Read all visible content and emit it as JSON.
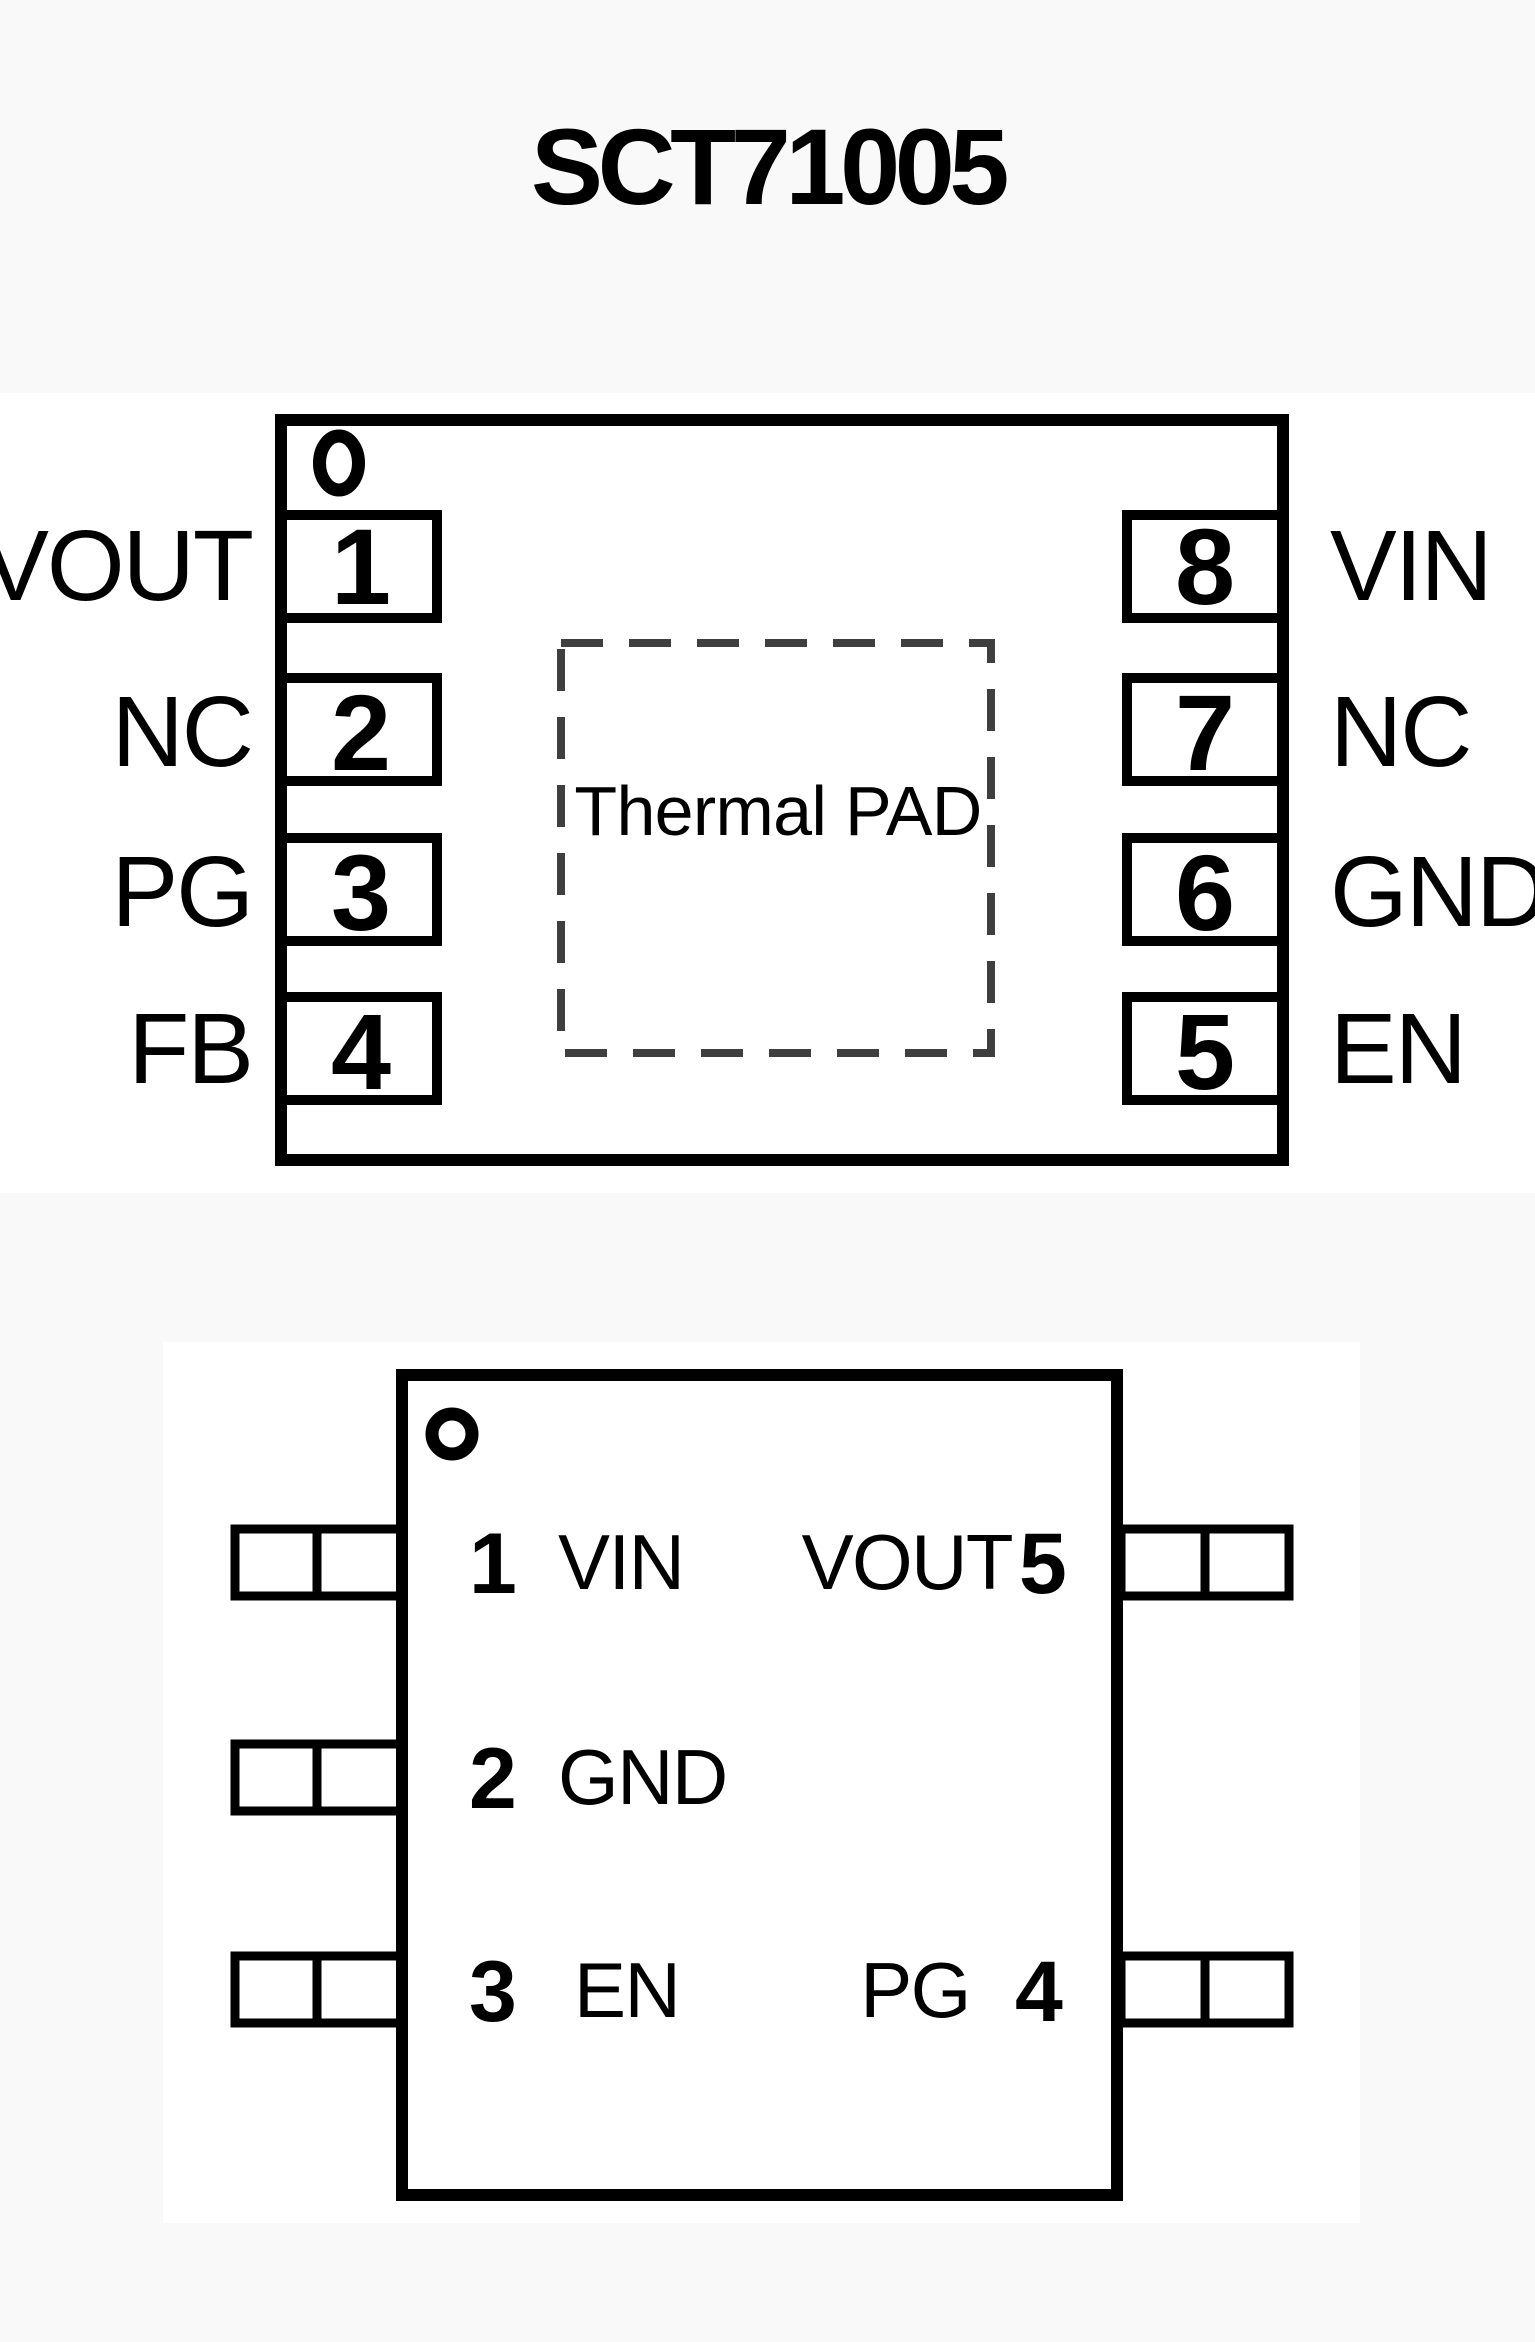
{
  "title": "SCT71005",
  "top_package": {
    "thermal_pad_label": "Thermal PAD",
    "left_pins": [
      {
        "number": "1",
        "name": "VOUT"
      },
      {
        "number": "2",
        "name": "NC"
      },
      {
        "number": "3",
        "name": "PG"
      },
      {
        "number": "4",
        "name": "FB"
      }
    ],
    "right_pins": [
      {
        "number": "8",
        "name": "VIN"
      },
      {
        "number": "7",
        "name": "NC"
      },
      {
        "number": "6",
        "name": "GND"
      },
      {
        "number": "5",
        "name": "EN"
      }
    ]
  },
  "bottom_package": {
    "left_pins": [
      {
        "number": "1",
        "name": "VIN"
      },
      {
        "number": "2",
        "name": "GND"
      },
      {
        "number": "3",
        "name": "EN"
      }
    ],
    "right_pins": [
      {
        "number": "5",
        "name": "VOUT"
      },
      {
        "number": "4",
        "name": "PG"
      }
    ]
  },
  "colors": {
    "line": "#000000",
    "thermal_dash": "#3f3f3f",
    "page_background": "#f9f9f9",
    "figure_background": "#ffffff"
  }
}
